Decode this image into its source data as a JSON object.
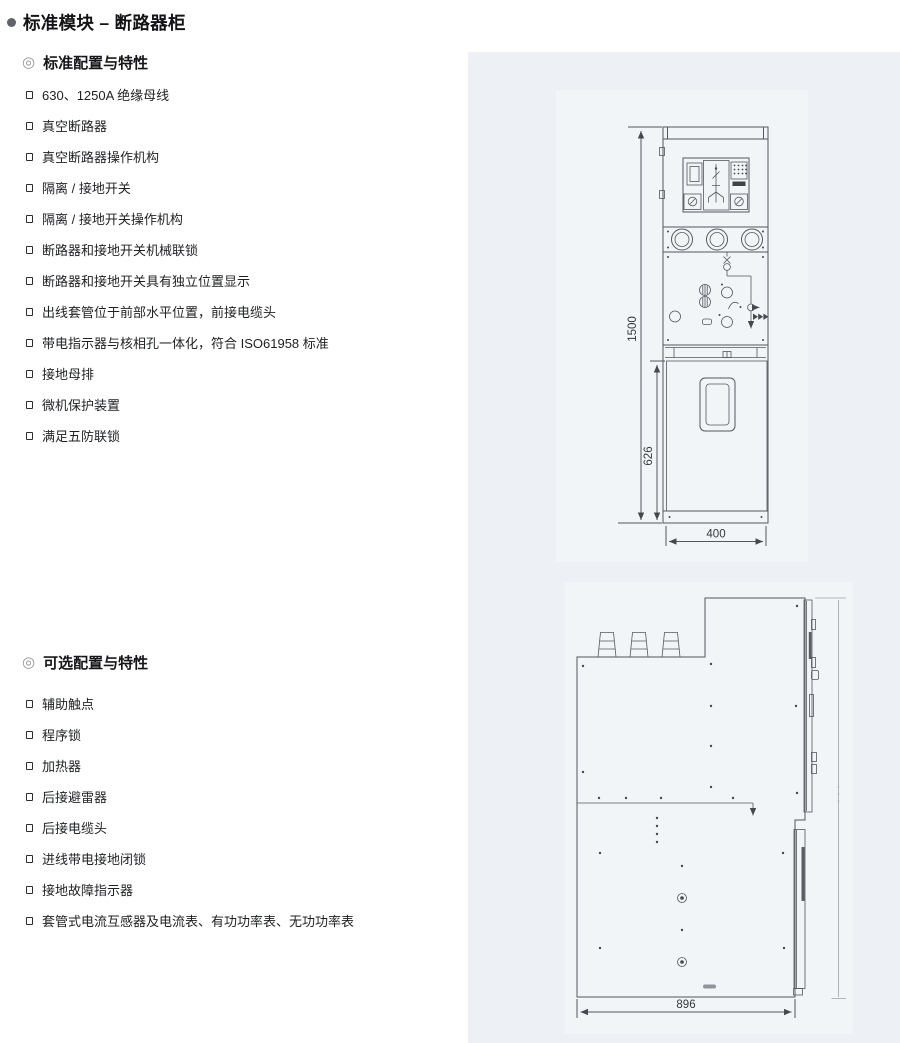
{
  "page": {
    "title": "标准模块 – 断路器柜"
  },
  "icons": {
    "title_bullet": "●",
    "section_bullet": "◎",
    "list_bullet": "¤"
  },
  "sections": [
    {
      "heading": "标准配置与特性",
      "items": [
        "630、1250A 绝缘母线",
        "真空断路器",
        "真空断路器操作机构",
        "隔离 / 接地开关",
        "隔离 / 接地开关操作机构",
        "断路器和接地开关机械联锁",
        "断路器和接地开关具有独立位置显示",
        "出线套管位于前部水平位置，前接电缆头",
        "带电指示器与核相孔一体化，符合 ISO61958 标准",
        "接地母排",
        "微机保护装置",
        "满足五防联锁"
      ]
    },
    {
      "heading": "可选配置与特性",
      "items": [
        "辅助触点",
        "程序锁",
        "加热器",
        "后接避雷器",
        "后接电缆头",
        "进线带电接地闭锁",
        "接地故障指示器",
        "套管式电流互感器及电流表、有功功率表、无功功率表"
      ]
    }
  ],
  "diagrams": {
    "front_view": {
      "dims": {
        "total_height": "1500",
        "lower_height": "626",
        "width": "400"
      }
    },
    "side_view": {
      "dims": {
        "depth": "896"
      }
    }
  },
  "colors": {
    "panel_bg": "#edf1f6",
    "scan_bg": "#f1f5f8",
    "line": "#54585d",
    "text": "#1f2023"
  }
}
